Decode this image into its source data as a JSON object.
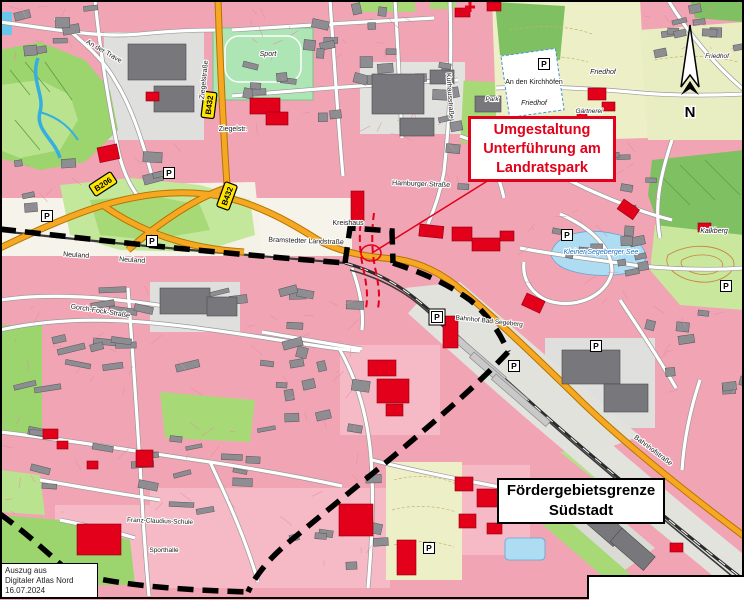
{
  "callouts": {
    "umgestaltung": {
      "lines": [
        "Umgestaltung",
        "Unterführung am",
        "Landratspark"
      ],
      "color": "#E2001A"
    },
    "foerdergebiet": {
      "lines": [
        "Fördergebietsgrenze",
        "Südstadt"
      ],
      "color": "#000000"
    }
  },
  "attribution": {
    "lines": [
      "Auszug aus",
      "Digitaler Atlas Nord",
      "16.07.2024"
    ]
  },
  "north": {
    "label": "N"
  },
  "route_badges": [
    {
      "text": "B206",
      "x": 103,
      "y": 184,
      "rot": -33
    },
    {
      "text": "B432",
      "x": 209,
      "y": 105,
      "rot": -83
    },
    {
      "text": "B432",
      "x": 227,
      "y": 196,
      "rot": -70
    }
  ],
  "parking": {
    "symbol": "P",
    "positions": [
      {
        "x": 47,
        "y": 216
      },
      {
        "x": 169,
        "y": 173
      },
      {
        "x": 152,
        "y": 241
      },
      {
        "x": 544,
        "y": 64
      },
      {
        "x": 567,
        "y": 235
      },
      {
        "x": 726,
        "y": 286
      },
      {
        "x": 437,
        "y": 317,
        "box": true
      },
      {
        "x": 514,
        "y": 366
      },
      {
        "x": 596,
        "y": 346
      },
      {
        "x": 429,
        "y": 548
      }
    ]
  },
  "street_labels": [
    {
      "text": "An der Trave",
      "x": 103,
      "y": 53,
      "rot": 30
    },
    {
      "text": "Ziegelstraße",
      "x": 206,
      "y": 80,
      "rot": -84
    },
    {
      "text": "Ziegelstr.",
      "x": 233,
      "y": 131,
      "rot": 0
    },
    {
      "text": "Neuland",
      "x": 76,
      "y": 257,
      "rot": 4
    },
    {
      "text": "Neuland",
      "x": 132,
      "y": 262,
      "rot": 4
    },
    {
      "text": "Gorch-Fock-Straße",
      "x": 100,
      "y": 313,
      "rot": 9
    },
    {
      "text": "Bramstedter Landstraße",
      "x": 306,
      "y": 243,
      "rot": 2
    },
    {
      "text": "Hamburger Straße",
      "x": 421,
      "y": 186,
      "rot": 2
    },
    {
      "text": "Kurhausstraße",
      "x": 448,
      "y": 96,
      "rot": 86
    },
    {
      "text": "An den Kirchhöfen",
      "x": 534,
      "y": 84,
      "rot": 0
    },
    {
      "text": "Bahnhofstraße",
      "x": 652,
      "y": 452,
      "rot": 37
    }
  ],
  "place_labels": [
    {
      "text": "Sport",
      "x": 268,
      "y": 56,
      "italic": true
    },
    {
      "text": "Kreishaus",
      "x": 348,
      "y": 225
    },
    {
      "text": "Friedhof",
      "x": 534,
      "y": 105,
      "italic": true
    },
    {
      "text": "Friedhof",
      "x": 603,
      "y": 74,
      "italic": true
    },
    {
      "text": "Friedhof",
      "x": 717,
      "y": 58,
      "italic": true,
      "size": 6.5
    },
    {
      "text": "Gärtnerei",
      "x": 589,
      "y": 113,
      "italic": true,
      "size": 6.5
    },
    {
      "text": "Kalkberg",
      "x": 714,
      "y": 233,
      "italic": true
    },
    {
      "text": "Kleiner Segeberger See",
      "x": 601,
      "y": 254,
      "italic": true,
      "color": "#1A6FC0"
    },
    {
      "text": "Bahnhof Bad Segeberg",
      "x": 489,
      "y": 323,
      "size": 6.5,
      "rot": 6
    },
    {
      "text": "Franz-Claudius-Schule",
      "x": 160,
      "y": 523,
      "size": 6.5,
      "rot": 2
    },
    {
      "text": "Sporthalle",
      "x": 164,
      "y": 552,
      "size": 6.5
    },
    {
      "text": "Park",
      "x": 492,
      "y": 101,
      "italic": true,
      "size": 6.5
    }
  ],
  "red_buildings": [
    {
      "x": 97,
      "y": 148,
      "w": 20,
      "h": 15,
      "rot": -12
    },
    {
      "x": 146,
      "y": 92,
      "w": 13,
      "h": 9,
      "rot": 0
    },
    {
      "x": 250,
      "y": 98,
      "w": 30,
      "h": 16,
      "rot": 0
    },
    {
      "x": 266,
      "y": 112,
      "w": 22,
      "h": 13,
      "rot": 0
    },
    {
      "x": 455,
      "y": 8,
      "w": 15,
      "h": 9,
      "rot": 0
    },
    {
      "x": 487,
      "y": 2,
      "w": 14,
      "h": 9,
      "rot": 0
    },
    {
      "x": 588,
      "y": 88,
      "w": 18,
      "h": 12,
      "rot": 0
    },
    {
      "x": 602,
      "y": 102,
      "w": 13,
      "h": 9,
      "rot": 0
    },
    {
      "x": 577,
      "y": 110,
      "w": 10,
      "h": 8,
      "rot": 0
    },
    {
      "x": 351,
      "y": 191,
      "w": 13,
      "h": 30,
      "rot": 0
    },
    {
      "x": 420,
      "y": 224,
      "w": 24,
      "h": 12,
      "rot": 6
    },
    {
      "x": 452,
      "y": 227,
      "w": 20,
      "h": 14,
      "rot": 0
    },
    {
      "x": 472,
      "y": 238,
      "w": 28,
      "h": 13,
      "rot": 0
    },
    {
      "x": 500,
      "y": 231,
      "w": 14,
      "h": 10,
      "rot": 0
    },
    {
      "x": 624,
      "y": 199,
      "w": 19,
      "h": 12,
      "rot": 35
    },
    {
      "x": 698,
      "y": 223,
      "w": 13,
      "h": 9,
      "rot": 0
    },
    {
      "x": 527,
      "y": 293,
      "w": 20,
      "h": 13,
      "rot": 25
    },
    {
      "x": 443,
      "y": 316,
      "w": 15,
      "h": 32,
      "rot": 0
    },
    {
      "x": 368,
      "y": 360,
      "w": 28,
      "h": 16,
      "rot": 0
    },
    {
      "x": 377,
      "y": 379,
      "w": 32,
      "h": 24,
      "rot": 0
    },
    {
      "x": 386,
      "y": 404,
      "w": 17,
      "h": 12,
      "rot": 0
    },
    {
      "x": 339,
      "y": 504,
      "w": 34,
      "h": 32,
      "rot": 0
    },
    {
      "x": 397,
      "y": 540,
      "w": 19,
      "h": 35,
      "rot": 0
    },
    {
      "x": 136,
      "y": 450,
      "w": 17,
      "h": 17,
      "rot": 0
    },
    {
      "x": 87,
      "y": 461,
      "w": 11,
      "h": 8,
      "rot": 0
    },
    {
      "x": 455,
      "y": 477,
      "w": 18,
      "h": 14,
      "rot": 0
    },
    {
      "x": 477,
      "y": 489,
      "w": 25,
      "h": 18,
      "rot": 0
    },
    {
      "x": 500,
      "y": 479,
      "w": 13,
      "h": 10,
      "rot": 0
    },
    {
      "x": 459,
      "y": 514,
      "w": 17,
      "h": 14,
      "rot": 0
    },
    {
      "x": 487,
      "y": 523,
      "w": 15,
      "h": 11,
      "rot": 0
    },
    {
      "x": 43,
      "y": 429,
      "w": 15,
      "h": 10,
      "rot": 0
    },
    {
      "x": 57,
      "y": 441,
      "w": 11,
      "h": 8,
      "rot": 0
    },
    {
      "x": 77,
      "y": 524,
      "w": 44,
      "h": 31,
      "rot": 0
    },
    {
      "x": 670,
      "y": 543,
      "w": 13,
      "h": 9,
      "rot": 0
    }
  ],
  "markers": {
    "hospital_cross": {
      "x": 470,
      "y": 7
    }
  },
  "colors": {
    "urban_pink": "#F1A4B3",
    "road_orange": "#F7A823",
    "highlight_red": "#E2001A",
    "forest_green": "#7FC162",
    "park_green": "#A8D977",
    "cemetery_green": "#EDEFC6",
    "water_blue": "#AEDCF2",
    "badge_yellow": "#FFE600"
  }
}
